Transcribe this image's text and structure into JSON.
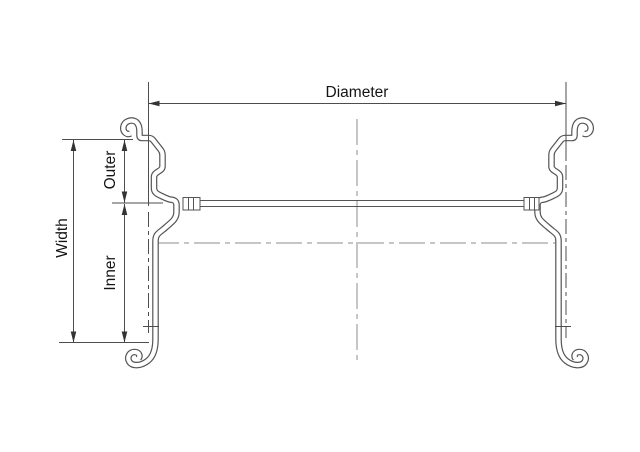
{
  "drawing": {
    "labels": {
      "diameter": "Diameter",
      "width": "Width",
      "outer": "Outer",
      "inner": "Inner"
    },
    "colors": {
      "background": "#ffffff",
      "line": "#4d4d4d",
      "centerline": "#8c8c8c",
      "profile": "#555555",
      "arrow": "#333333",
      "text": "#141414"
    }
  }
}
